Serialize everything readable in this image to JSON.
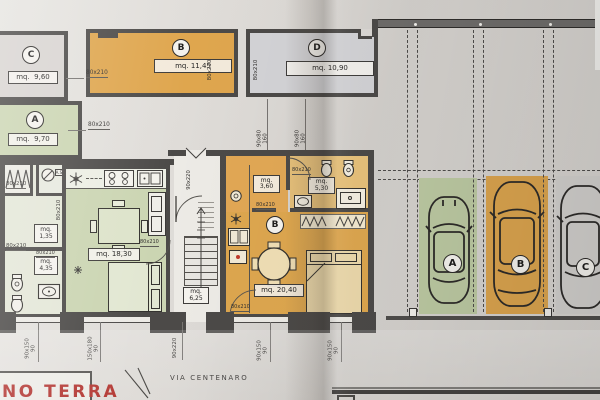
{
  "footer": {
    "plan_label": "NO TERRA",
    "street": "VIA CENTENARO"
  },
  "storage_rooms": {
    "c": {
      "id": "C",
      "area": "mq.  9,60"
    },
    "b": {
      "id": "B",
      "area": "mq. 11,45"
    },
    "d": {
      "id": "D",
      "area": "mq. 10,90"
    },
    "a": {
      "id": "A",
      "area": "mq.  9,70"
    }
  },
  "apartment_left": {
    "as_label": "A.S.",
    "hall": {
      "l1": "mq.",
      "l2": "1,35"
    },
    "bath": {
      "l1": "mq.",
      "l2": "4,35"
    },
    "living": {
      "area": "mq. 18,30"
    }
  },
  "stairwell": {
    "landing": {
      "l1": "mq.",
      "l2": "6,25"
    }
  },
  "apartment_right": {
    "id": "B",
    "hall": {
      "l1": "mq.",
      "l2": "3,60"
    },
    "bath": {
      "l1": "mq.",
      "l2": "5,30"
    },
    "living": {
      "area": "mq. 20,40"
    }
  },
  "dims": {
    "door80": "80x210",
    "door90": "90x220",
    "win_top": {
      "l1": "90x80",
      "l2": "160"
    },
    "win_a": {
      "l1": "90x150",
      "l2": "90"
    },
    "win_b": {
      "l1": "150x180",
      "l2": "90"
    }
  },
  "parking": {
    "a": "A",
    "b": "B",
    "c": "C"
  },
  "colors": {
    "wall": "#4c4a48",
    "orange": "#dfa64e",
    "green": "#c8d3ae",
    "gray": "#d6d3d3",
    "red_title": "#b23530"
  }
}
